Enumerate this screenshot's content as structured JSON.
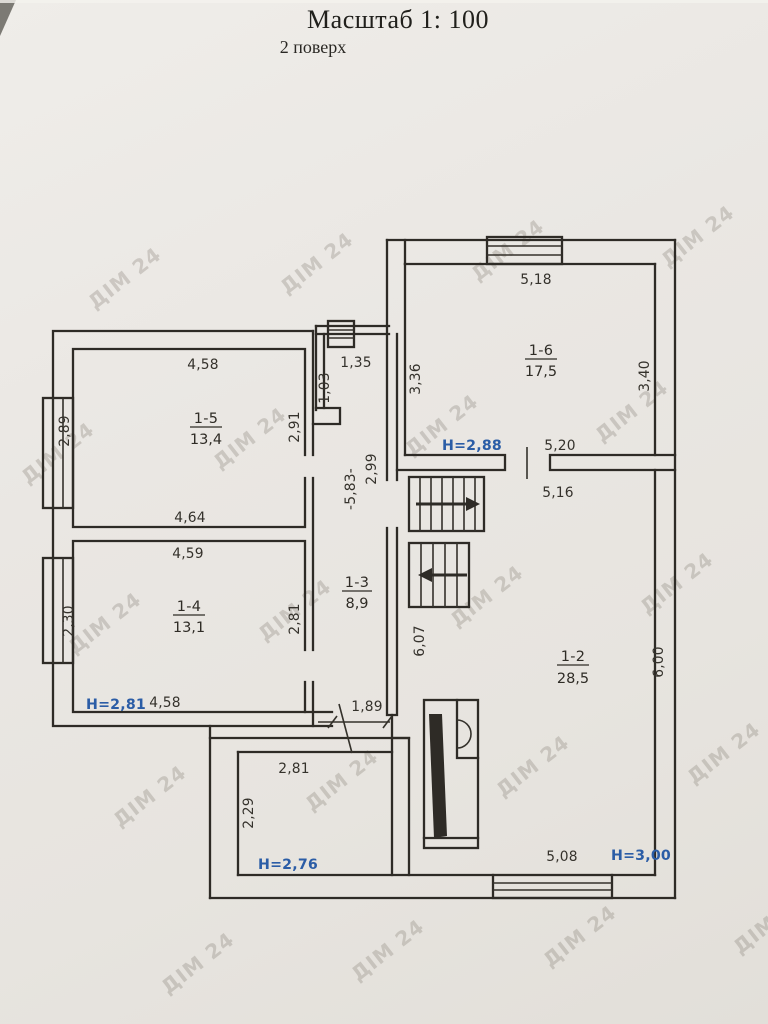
{
  "page": {
    "title": "Масштаб 1: 100",
    "subtitle": "2 поверх",
    "watermark": "ДІМ 24"
  },
  "colors": {
    "ink": "#2e2b26",
    "height_labels": "#2b5da6",
    "paper": "#e9e6e2"
  },
  "rooms": {
    "r1_5": {
      "id": "1-5",
      "area": "13,4",
      "dim_top": "4,58",
      "dim_left": "2,89",
      "dim_right": "2,91",
      "dim_bottom": "4,64"
    },
    "r1_4": {
      "id": "1-4",
      "area": "13,1",
      "dim_top": "4,59",
      "dim_left": "2,30",
      "dim_right": "2,81",
      "dim_bottom": "4,58",
      "ceiling_height": "H=2,81"
    },
    "r1_3": {
      "id": "1-3",
      "area": "8,9",
      "dim_top": "1,35",
      "dim_top_left": "1,03",
      "dim_right_upper": "2,99",
      "dim_length": "-5,83-",
      "dim_bottom_door": "1,89"
    },
    "r1_6": {
      "id": "1-6",
      "area": "17,5",
      "dim_top": "5,18",
      "dim_left": "3,36",
      "dim_right": "3,40",
      "dim_bottom": "5,20",
      "dim_below_wall": "5,16",
      "ceiling_height": "H=2,88"
    },
    "r1_2": {
      "id": "1-2",
      "area": "28,5",
      "dim_left": "6,07",
      "dim_right": "6,00",
      "dim_bottom": "5,08",
      "ceiling_height": "H=3,00"
    },
    "r_sw": {
      "dim_top": "2,81",
      "dim_left": "2,29",
      "ceiling_height": "H=2,76"
    }
  }
}
